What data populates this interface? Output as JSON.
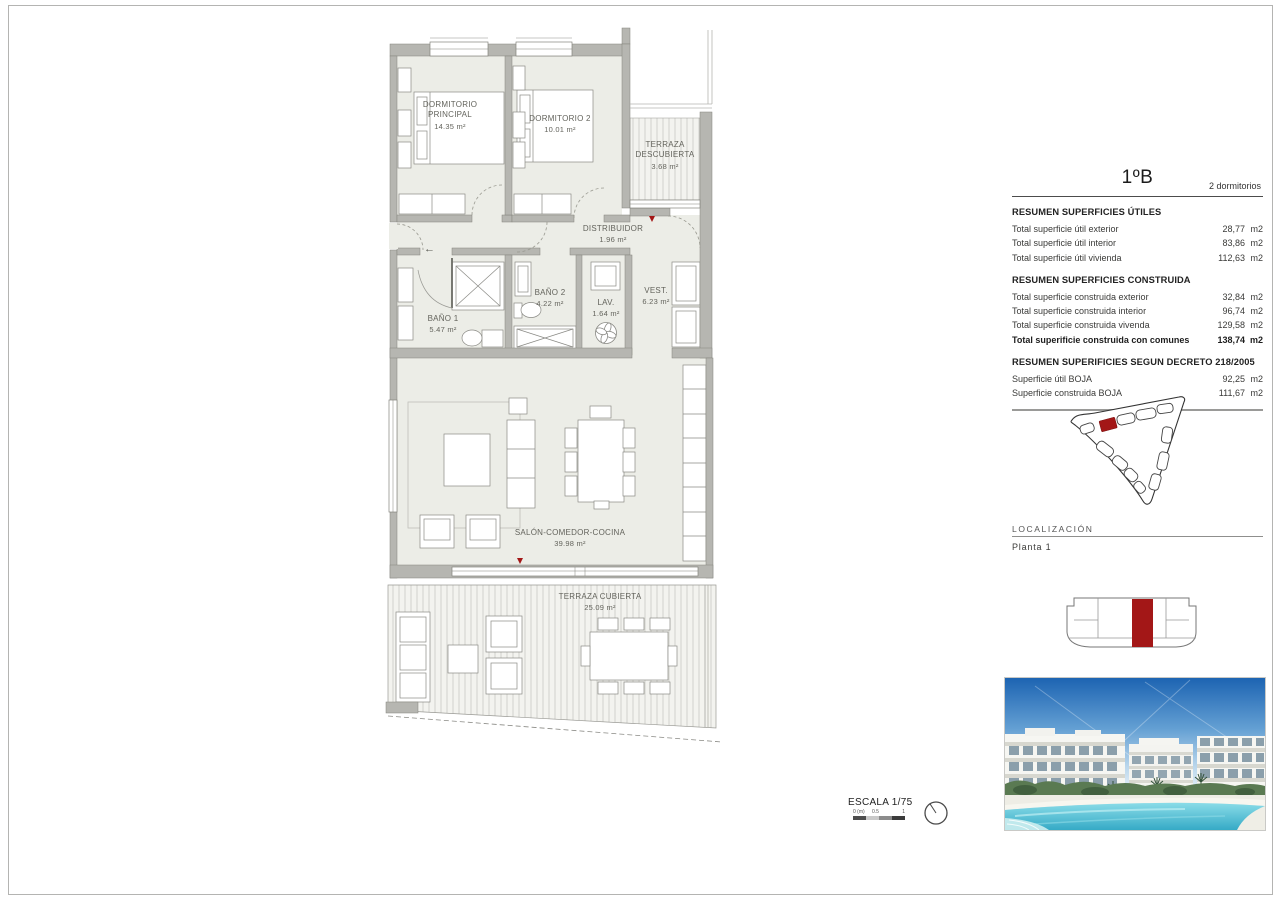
{
  "colors": {
    "accent_red": "#a31717"
  },
  "plan": {
    "entry_arrow": "←",
    "rooms": [
      {
        "name": "DORMITORIO PRINCIPAL",
        "area": "14.35 m²"
      },
      {
        "name": "DORMITORIO 2",
        "area": "10.01 m²"
      },
      {
        "name": "TERRAZA DESCUBIERTA",
        "area": "3.68 m²"
      },
      {
        "name": "DISTRIBUIDOR",
        "area": "1.96 m²"
      },
      {
        "name": "BAÑO 1",
        "area": "5.47 m²"
      },
      {
        "name": "BAÑO 2",
        "area": "4.22 m²"
      },
      {
        "name": "LAV.",
        "area": "1.64 m²"
      },
      {
        "name": "VEST.",
        "area": "6.23 m²"
      },
      {
        "name": "SALÓN-COMEDOR-COCINA",
        "area": "39.98 m²"
      },
      {
        "name": "TERRAZA CUBIERTA",
        "area": "25.09 m²"
      }
    ]
  },
  "summary": {
    "title": "1ºB",
    "subtitle": "2 dormitorios",
    "sections": [
      {
        "heading": "RESUMEN SUPERFICIES ÚTILES",
        "rows": [
          {
            "label": "Total superficie útil exterior",
            "value": "28,77",
            "unit": "m2",
            "bold": false
          },
          {
            "label": "Total superficie útil interior",
            "value": "83,86",
            "unit": "m2",
            "bold": false
          },
          {
            "label": "Total superficie útil vivienda",
            "value": "112,63",
            "unit": "m2",
            "bold": false
          }
        ]
      },
      {
        "heading": "RESUMEN SUPERFICIES CONSTRUIDA",
        "rows": [
          {
            "label": "Total superficie construida exterior",
            "value": "32,84",
            "unit": "m2",
            "bold": false
          },
          {
            "label": "Total superficie construida interior",
            "value": "96,74",
            "unit": "m2",
            "bold": false
          },
          {
            "label": "Total superficie construida vivenda",
            "value": "129,58",
            "unit": "m2",
            "bold": false
          },
          {
            "label": "Total superificie construida con comunes",
            "value": "138,74",
            "unit": "m2",
            "bold": true
          }
        ]
      },
      {
        "heading": "RESUMEN SUPERIFICIES SEGUN DECRETO 218/2005",
        "rows": [
          {
            "label": "Superficie útil BOJA",
            "value": "92,25",
            "unit": "m2",
            "bold": false
          },
          {
            "label": "Superficie construida BOJA",
            "value": "111,67",
            "unit": "m2",
            "bold": false
          }
        ]
      }
    ]
  },
  "localizacion": {
    "heading": "LOCALIZACIÓN",
    "floor_label": "Planta 1"
  },
  "escala": {
    "label": "ESCALA 1/75",
    "ticks": [
      "0 (m)",
      "0.5",
      "1"
    ]
  }
}
